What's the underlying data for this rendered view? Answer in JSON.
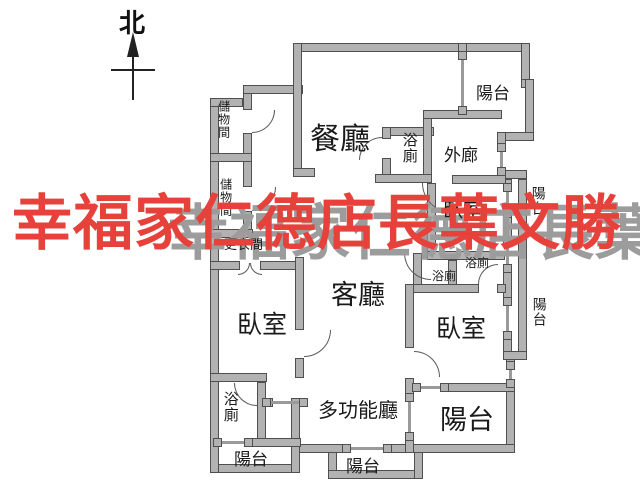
{
  "compass": {
    "north_label": "北"
  },
  "watermark": {
    "text": "幸福家仁德店長葉文勝",
    "color": "#e6413a",
    "shadow_color": "#9c9c9c"
  },
  "colors": {
    "background": "#ffffff",
    "wall_fill": "#b2b2b2",
    "wall_outline": "#4f4f4f",
    "label": "#1a1a1a"
  },
  "rooms": {
    "dining": "餐廳",
    "living": "客廳",
    "multi_function": "多功能廳",
    "bedroom": "臥室",
    "balcony": "陽台",
    "bathroom": "浴廁",
    "outer_corridor": "外廊",
    "storage": "儲物間",
    "dressing": "更衣間"
  }
}
